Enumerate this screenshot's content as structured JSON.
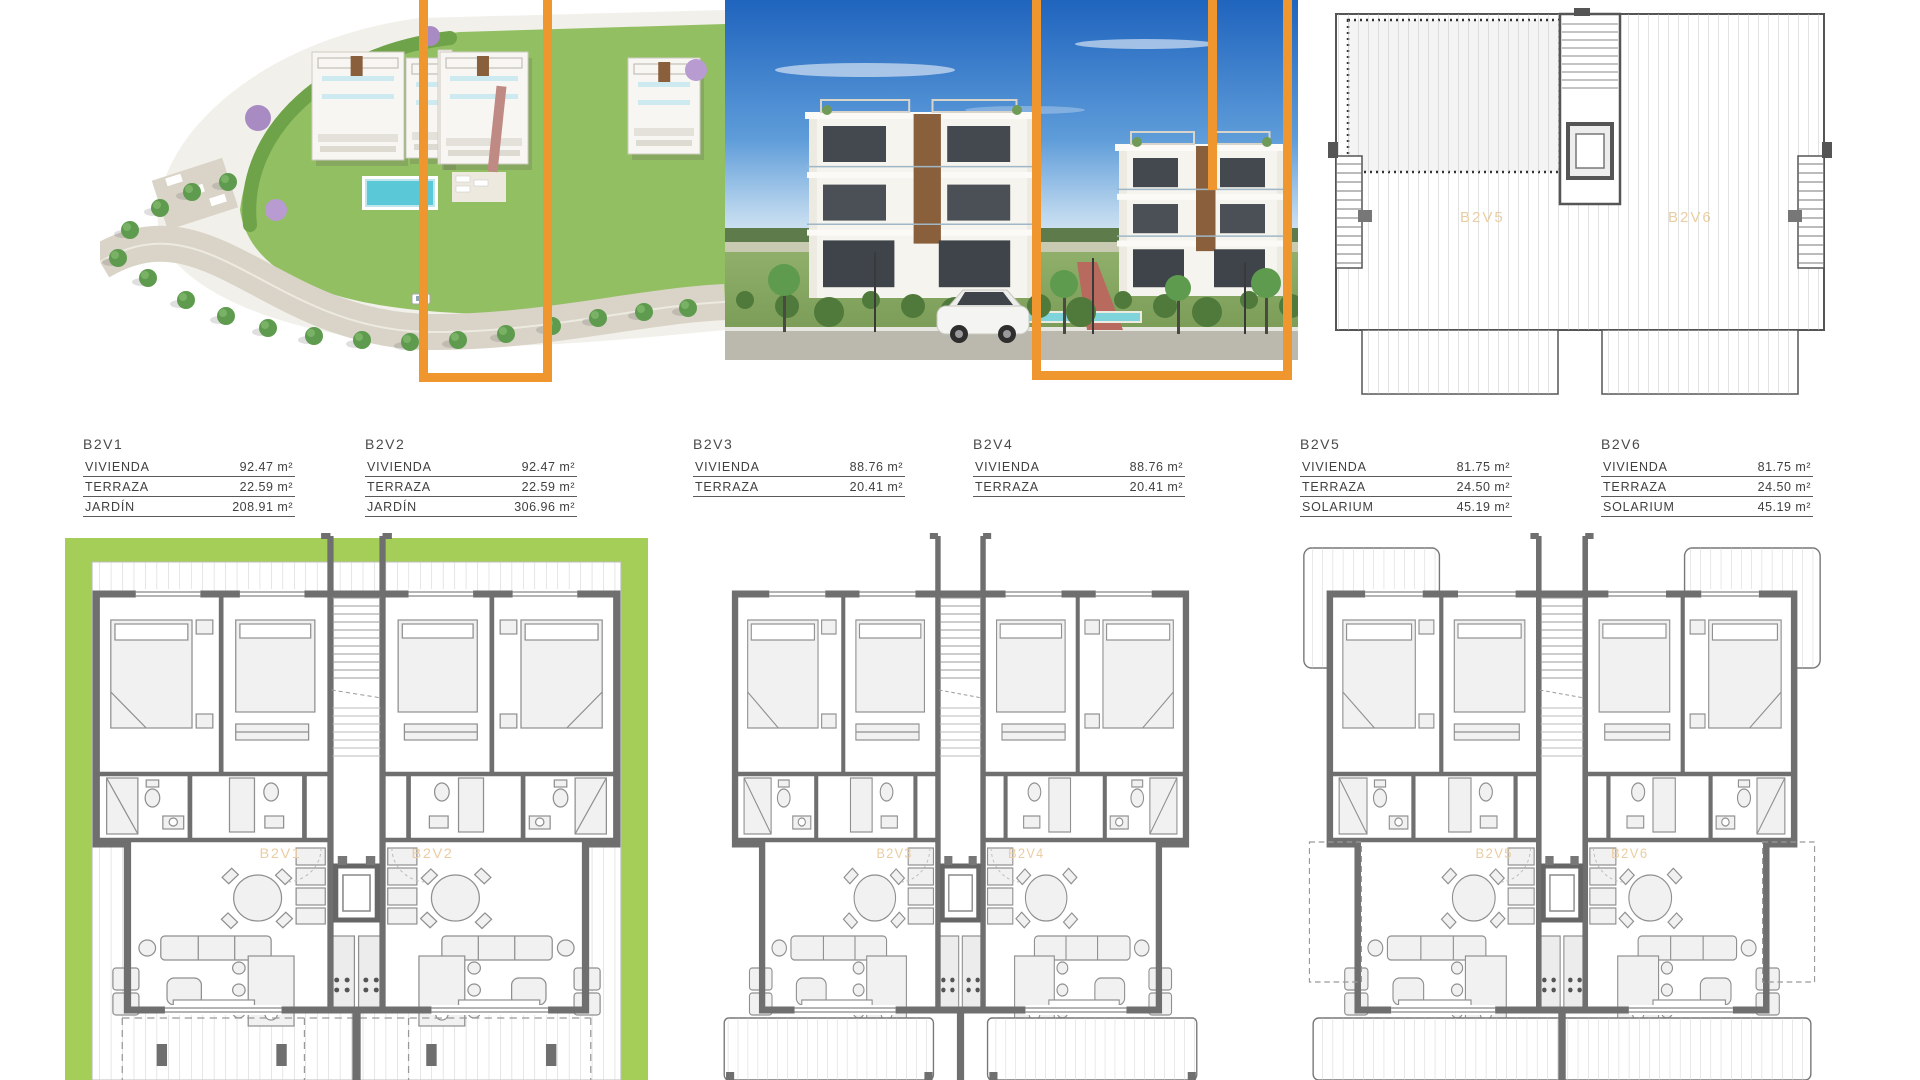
{
  "title": {
    "text": "BLOQUE 2"
  },
  "colors": {
    "highlight_orange": "#F0962E",
    "title_orange": "#E9AC60",
    "unit_label_orange": "#EACDA2",
    "garden_green": "#A4CE58",
    "wall_gray": "#6E6E6E",
    "hatch_gray": "#C9C9C9",
    "cad_text": "#3F3F3F",
    "pool_blue": "#5BC8D8",
    "sky_blue": "#2465BE"
  },
  "unit_tables": [
    {
      "id": "B2V1",
      "rows": [
        {
          "label": "VIVIENDA",
          "value": "92.47 m²"
        },
        {
          "label": "TERRAZA",
          "value": "22.59 m²"
        },
        {
          "label": "JARDÍN",
          "value": "208.91 m²"
        }
      ]
    },
    {
      "id": "B2V2",
      "rows": [
        {
          "label": "VIVIENDA",
          "value": "92.47 m²"
        },
        {
          "label": "TERRAZA",
          "value": "22.59 m²"
        },
        {
          "label": "JARDÍN",
          "value": "306.96 m²"
        }
      ]
    },
    {
      "id": "B2V3",
      "rows": [
        {
          "label": "VIVIENDA",
          "value": "88.76 m²"
        },
        {
          "label": "TERRAZA",
          "value": "20.41 m²"
        }
      ]
    },
    {
      "id": "B2V4",
      "rows": [
        {
          "label": "VIVIENDA",
          "value": "88.76 m²"
        },
        {
          "label": "TERRAZA",
          "value": "20.41 m²"
        }
      ]
    },
    {
      "id": "B2V5",
      "rows": [
        {
          "label": "VIVIENDA",
          "value": "81.75 m²"
        },
        {
          "label": "TERRAZA",
          "value": "24.50 m²"
        },
        {
          "label": "SOLARIUM",
          "value": "45.19 m²"
        }
      ]
    },
    {
      "id": "B2V6",
      "rows": [
        {
          "label": "VIVIENDA",
          "value": "81.75 m²"
        },
        {
          "label": "TERRAZA",
          "value": "24.50 m²"
        },
        {
          "label": "SOLARIUM",
          "value": "45.19 m²"
        }
      ]
    }
  ],
  "floor_plans": [
    {
      "variant": "ground",
      "units": [
        "B2V1",
        "B2V2"
      ]
    },
    {
      "variant": "first",
      "units": [
        "B2V3",
        "B2V4"
      ]
    },
    {
      "variant": "second",
      "units": [
        "B2V5",
        "B2V6"
      ]
    }
  ],
  "roof_plan": {
    "units": [
      "B2V5",
      "B2V6"
    ]
  }
}
